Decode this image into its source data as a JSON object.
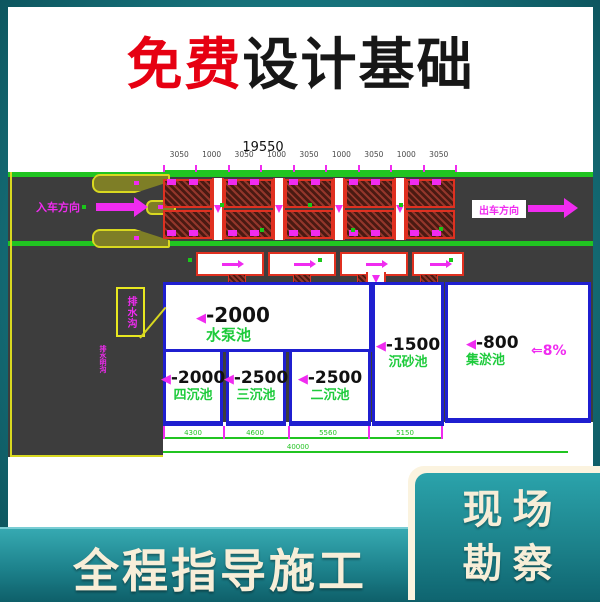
{
  "title": {
    "highlight": "免费",
    "rest": "设计基础"
  },
  "drawing": {
    "dim_total": "19550",
    "dim_segments": [
      "3050",
      "1000",
      "3050",
      "1000",
      "3050",
      "1000",
      "3050",
      "1000",
      "3050"
    ],
    "bay_count": 5,
    "entry_label": "入车方向",
    "exit_label": "出车方向",
    "callout_label": "排水沟",
    "callout_small": "排水明沟",
    "depth_marker": "◀",
    "slope_label": "⇐8%",
    "pools": [
      {
        "depth": "-2000",
        "name": "水泵池"
      },
      {
        "depth": "-2000",
        "name": "四沉池"
      },
      {
        "depth": "-2500",
        "name": "三沉池"
      },
      {
        "depth": "-2500",
        "name": "二沉池"
      },
      {
        "depth": "-1500",
        "name": "沉砂池"
      },
      {
        "depth": "-800",
        "name": "集淤池"
      }
    ],
    "bottom_dims": [
      "4300",
      "4600",
      "5560",
      "5150"
    ],
    "bottom_total": "40000"
  },
  "banner": {
    "left_text": "全程指导施工"
  },
  "promo": {
    "line1": "现场",
    "line2": "勘察"
  },
  "colors": {
    "teal_background": "#17747d",
    "title_red": "#e60012",
    "cad_green": "#21c421",
    "cad_magenta": "#f02bf0",
    "pool_border_blue": "#1f1fd0",
    "pool_name_green": "#1ecb3c",
    "banner_cream": "#f7eed8"
  }
}
